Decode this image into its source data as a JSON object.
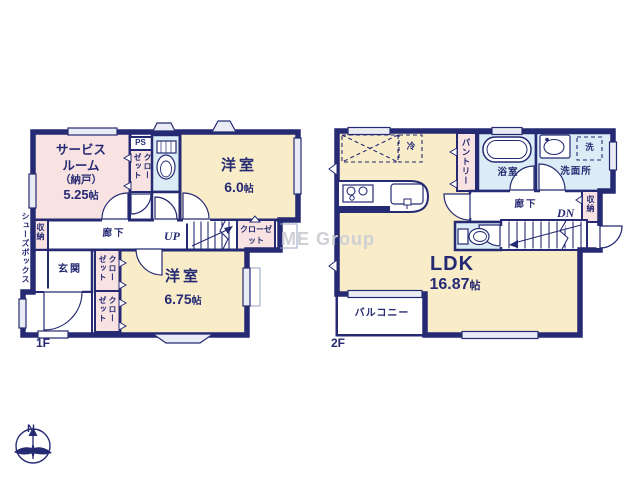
{
  "watermark": "ME Group",
  "compass": {
    "north": "N"
  },
  "floor1": {
    "label": "1F",
    "service_room": {
      "line1": "サービス",
      "line2": "ルーム",
      "line3": "（納戸）",
      "size": "5.25",
      "unit": "帖"
    },
    "ps": "PS",
    "closet": "クローゼット",
    "room_a": {
      "name": "洋室",
      "size": "6.0",
      "unit": "帖"
    },
    "corridor": "廊下",
    "stairs": "UP",
    "stairs_closet": "クローゼット",
    "storage": "収納",
    "shoes_box": "シューズボックス",
    "entrance": "玄関",
    "closet_a": "クローゼット",
    "closet_b": "クローゼット",
    "room_b": {
      "name": "洋室",
      "size": "6.75",
      "unit": "帖"
    }
  },
  "floor2": {
    "label": "2F",
    "fridge": "冷",
    "pantry": "パントリー",
    "bathroom": "浴室",
    "washroom": "洗面所",
    "washer": "洗",
    "corridor": "廊下",
    "stairs": "DN",
    "storage": "収納",
    "ldk": {
      "name": "LDK",
      "size": "16.87",
      "unit": "帖"
    },
    "balcony": "バルコニー"
  }
}
